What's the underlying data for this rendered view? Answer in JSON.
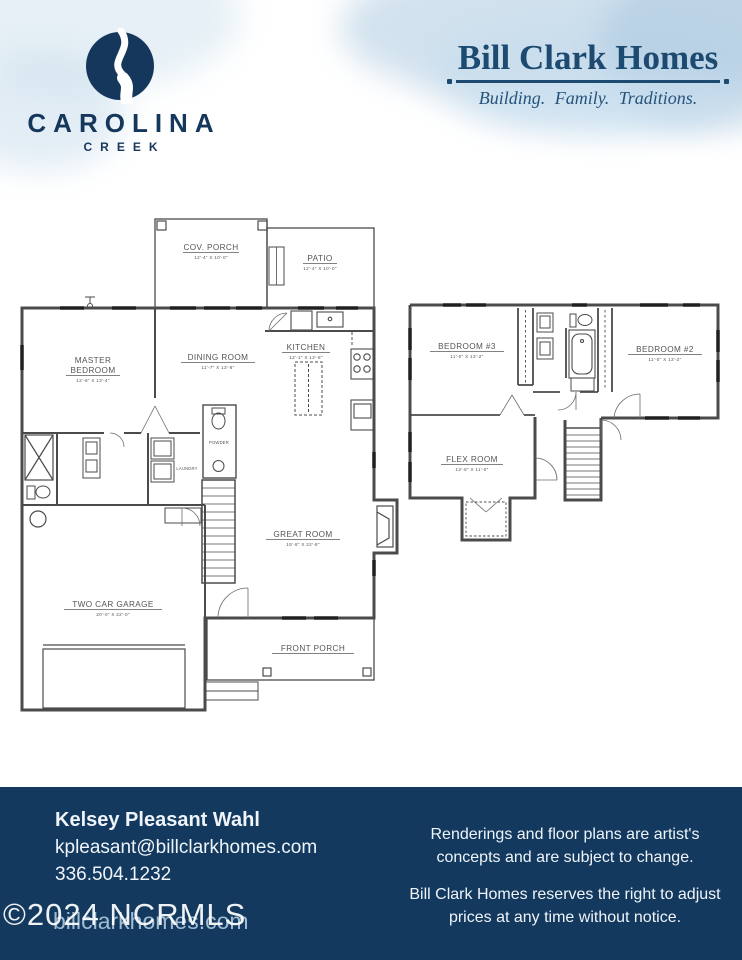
{
  "header": {
    "community": {
      "icon": "carolina-creek-river-icon",
      "name": "CAROLINA",
      "subname": "CREEK"
    },
    "builder": {
      "name": "Bill Clark Homes",
      "tagline": "Building. Family. Traditions."
    }
  },
  "floor1": {
    "cov_porch": {
      "label": "COV. PORCH",
      "dims": "12'-4\" X 10'-0\""
    },
    "patio": {
      "label": "PATIO",
      "dims": "12'-4\" X 10'-0\""
    },
    "master": {
      "label1": "MASTER",
      "label2": "BEDROOM",
      "dims": "12'-8\" X 13'-4\""
    },
    "dining": {
      "label": "DINING ROOM",
      "dims": "11'-7\" X 13'-8\""
    },
    "kitchen": {
      "label": "KITCHEN",
      "dims": "12'-1\" X 13'-8\""
    },
    "great": {
      "label": "GREAT ROOM",
      "dims": "15'-8\" X 22'-8\""
    },
    "garage": {
      "label": "TWO CAR GARAGE",
      "dims": "20'-0\" X 22'-0\""
    },
    "front_porch": {
      "label": "FRONT PORCH"
    },
    "laundry": {
      "label": "LAUNDRY"
    },
    "powder": {
      "label": "POWDER"
    }
  },
  "floor2": {
    "bed3": {
      "label": "BEDROOM #3",
      "dims": "11'-0\" X 13'-2\""
    },
    "bed2": {
      "label": "BEDROOM #2",
      "dims": "11'-0\" X 13'-2\""
    },
    "flex": {
      "label": "FLEX ROOM",
      "dims": "13'-8\" X 11'-0\""
    }
  },
  "footer": {
    "agent_name": "Kelsey Pleasant Wahl",
    "agent_email": "kpleasant@billclarkhomes.com",
    "agent_phone": "336.504.1232",
    "watermark": "©2024 NCRMLS",
    "watermark_site": "billclarkhomes.com",
    "disclaimer_1": "Renderings and floor plans are artist's concepts and are subject to change.",
    "disclaimer_2": "Bill Clark Homes reserves the right to adjust prices at any time without notice."
  },
  "colors": {
    "footer_navy": "#14395e",
    "logo_navy": "#16375c",
    "builder_navy": "#1c4a70",
    "plan_line": "#4b4b4b"
  }
}
